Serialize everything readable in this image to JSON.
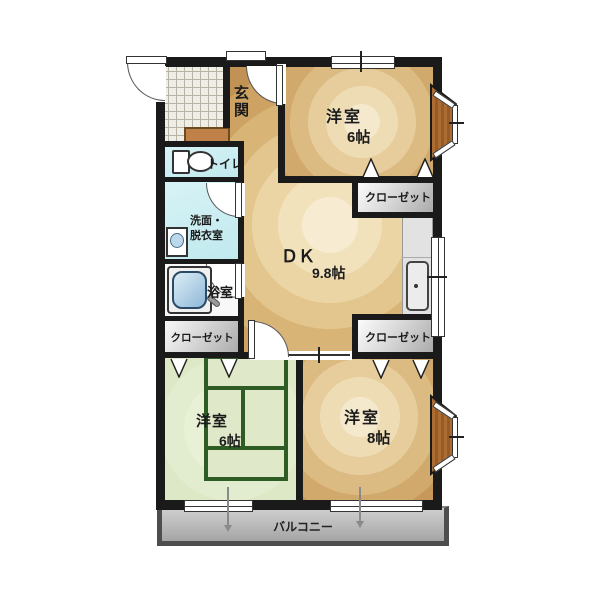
{
  "plan": {
    "type": "apartment-floor-plan",
    "rooms": {
      "genkan": {
        "label": "玄関"
      },
      "west_room_top": {
        "label": "洋室",
        "size": "6帖"
      },
      "toilet": {
        "label": "トイレ"
      },
      "washroom": {
        "label_line1": "洗面・",
        "label_line2": "脱衣室"
      },
      "bathroom": {
        "label": "浴室"
      },
      "dk": {
        "label": "ＤＫ",
        "size": "9.8帖"
      },
      "closet_top_right": {
        "label": "クローゼット"
      },
      "closet_left": {
        "label": "クローゼット"
      },
      "closet_bottom_right": {
        "label": "クローゼット"
      },
      "west_room_bottom_left": {
        "label": "洋室",
        "size": "6帖"
      },
      "west_room_bottom_right": {
        "label": "洋室",
        "size": "8帖"
      },
      "balcony": {
        "label": "バルコニー"
      }
    },
    "colors": {
      "wall": "#1a1a1a",
      "room_brown_outer": "#bf8d4f",
      "room_brown_center": "#f7ecd2",
      "green_room": "#dde8c6",
      "tatami_line": "#2f5c24",
      "wet_area_cyan": "#c9ecf1",
      "closet_gray": "#b0b0b0",
      "balcony_gray": "#bcbcbc",
      "bay_window_wood": "#a5682f"
    }
  }
}
